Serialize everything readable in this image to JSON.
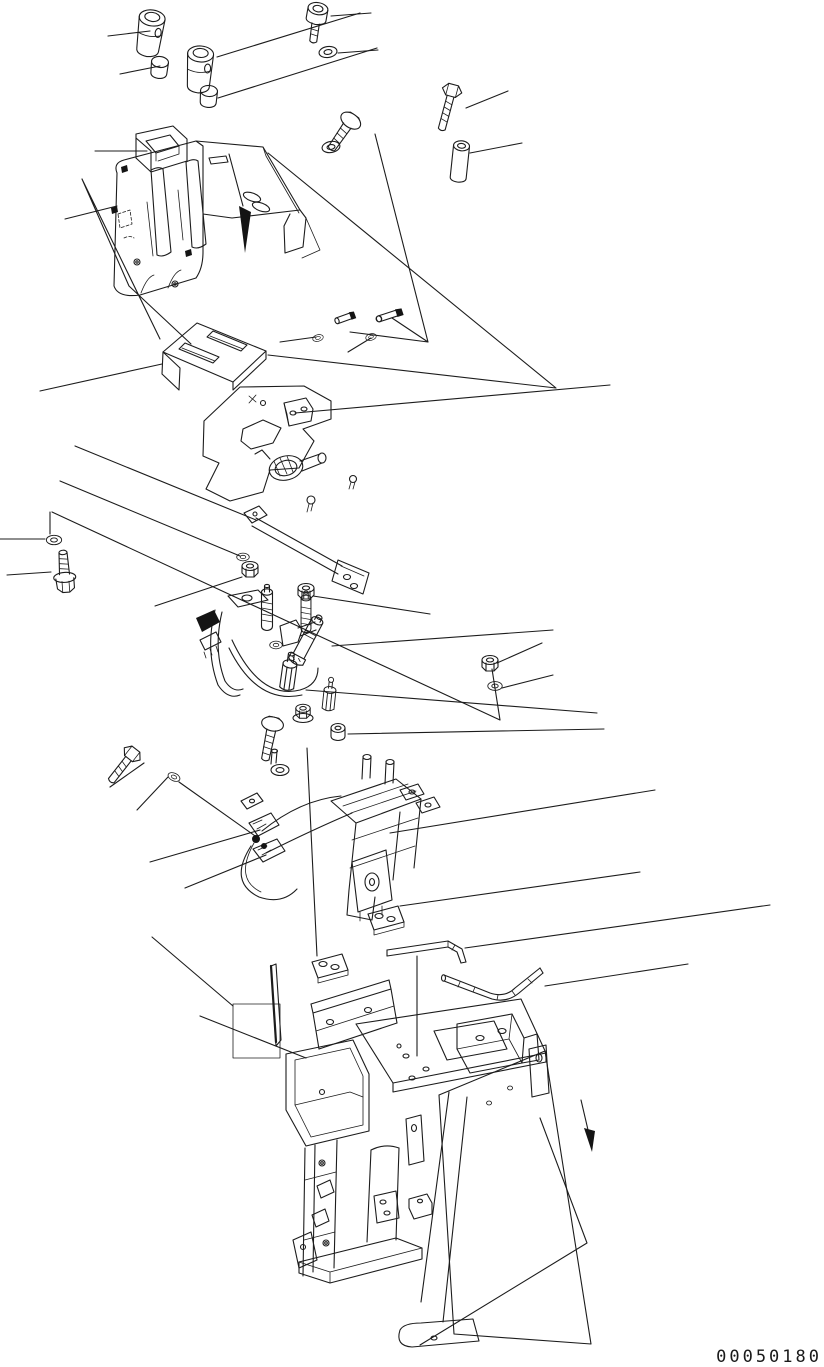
{
  "diagram": {
    "figure_type": "exploded-parts-view",
    "drawing_number": "00050180",
    "background_color": "#ffffff",
    "line_color": "#1c1c1c",
    "direction_arrow_count": 2,
    "parts": [
      {
        "id": 1,
        "name": "lever-knob-1"
      },
      {
        "id": 2,
        "name": "lever-knob-2"
      },
      {
        "id": 3,
        "name": "knob-cap-1"
      },
      {
        "id": 4,
        "name": "knob-cap-2"
      },
      {
        "id": 5,
        "name": "socket-head-screw"
      },
      {
        "id": 6,
        "name": "washer-top-1"
      },
      {
        "id": 7,
        "name": "hex-bolt-top-right"
      },
      {
        "id": 8,
        "name": "spacer-collar"
      },
      {
        "id": 9,
        "name": "hex-bolt-top-middle"
      },
      {
        "id": 10,
        "name": "washer-top-2"
      },
      {
        "id": 11,
        "name": "console-cover"
      },
      {
        "id": 12,
        "name": "connector-block"
      },
      {
        "id": 13,
        "name": "cover-mounting-plate"
      },
      {
        "id": 14,
        "name": "boot-plate"
      },
      {
        "id": 15,
        "name": "lever-slot-plate"
      },
      {
        "id": 16,
        "name": "hinge-bracket"
      },
      {
        "id": 17,
        "name": "clevis-pin-1"
      },
      {
        "id": 18,
        "name": "clevis-pin-2"
      },
      {
        "id": 19,
        "name": "pin-washer-1"
      },
      {
        "id": 20,
        "name": "pin-washer-2"
      },
      {
        "id": 21,
        "name": "damper-lever"
      },
      {
        "id": 22,
        "name": "support-bracket"
      },
      {
        "id": 23,
        "name": "hex-nut-1"
      },
      {
        "id": 24,
        "name": "hex-nut-2"
      },
      {
        "id": 25,
        "name": "threaded-stud-1"
      },
      {
        "id": 26,
        "name": "threaded-stud-2"
      },
      {
        "id": 27,
        "name": "wire-clamp-bracket"
      },
      {
        "id": 28,
        "name": "lever-valve-body"
      },
      {
        "id": 29,
        "name": "sensor-cylinder"
      },
      {
        "id": 30,
        "name": "standoff-1"
      },
      {
        "id": 31,
        "name": "standoff-2"
      },
      {
        "id": 32,
        "name": "flange-nut"
      },
      {
        "id": 33,
        "name": "cap-nut"
      },
      {
        "id": 34,
        "name": "hex-bolt-center"
      },
      {
        "id": 35,
        "name": "washer-center"
      },
      {
        "id": 36,
        "name": "washer-left"
      },
      {
        "id": 37,
        "name": "flange-bolt-left"
      },
      {
        "id": 38,
        "name": "hex-bolt-lower-left"
      },
      {
        "id": 39,
        "name": "washer-lower-left"
      },
      {
        "id": 40,
        "name": "hex-nut-right"
      },
      {
        "id": 41,
        "name": "washer-right"
      },
      {
        "id": 42,
        "name": "solenoid-valve-assembly"
      },
      {
        "id": 43,
        "name": "terminal-plate-1"
      },
      {
        "id": 44,
        "name": "terminal-plate-2"
      },
      {
        "id": 45,
        "name": "flat-bent-bar"
      },
      {
        "id": 46,
        "name": "bent-rod"
      },
      {
        "id": 47,
        "name": "shim-blade"
      },
      {
        "id": 48,
        "name": "console-frame-stand"
      }
    ]
  }
}
